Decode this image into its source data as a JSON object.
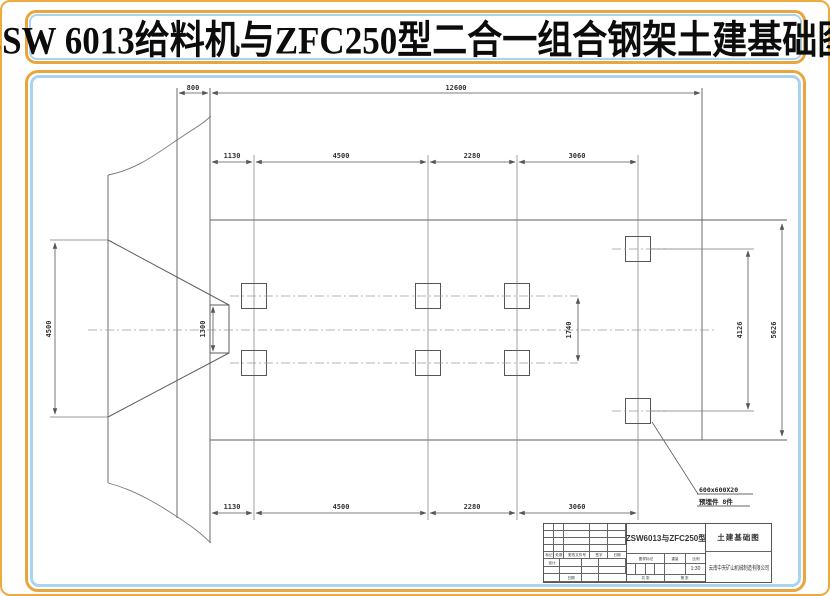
{
  "banner": {
    "title": "ZSW 6013给料机与ZFC250型二合一组合钢架土建基础图"
  },
  "drawing": {
    "dims": {
      "top": {
        "left": "800",
        "overall": "12600"
      },
      "cols": [
        "1130",
        "4500",
        "2280",
        "3060"
      ],
      "hopper_width": "4500",
      "outlet": "1300",
      "row_gap": "1740",
      "right_inner": "4126",
      "right_overall": "5626"
    },
    "annotation": {
      "line1": "600x600X20",
      "line2": "预埋件  8件"
    }
  },
  "title_block": {
    "rev_headers": [
      "标记",
      "处数",
      "更改文件号",
      "签字",
      "日期"
    ],
    "design_label": "设计",
    "date_label": "日期",
    "model": "ZSW6013与ZFC250型",
    "doc_title": "土建基础图",
    "mark_label": "图样标记",
    "weight_label": "重量",
    "scale_label": "比例",
    "scale_value": "1:30",
    "sheet_total": "共  张",
    "sheet_no": "第  张",
    "company": "云南中天矿山机械制造有限公司"
  }
}
